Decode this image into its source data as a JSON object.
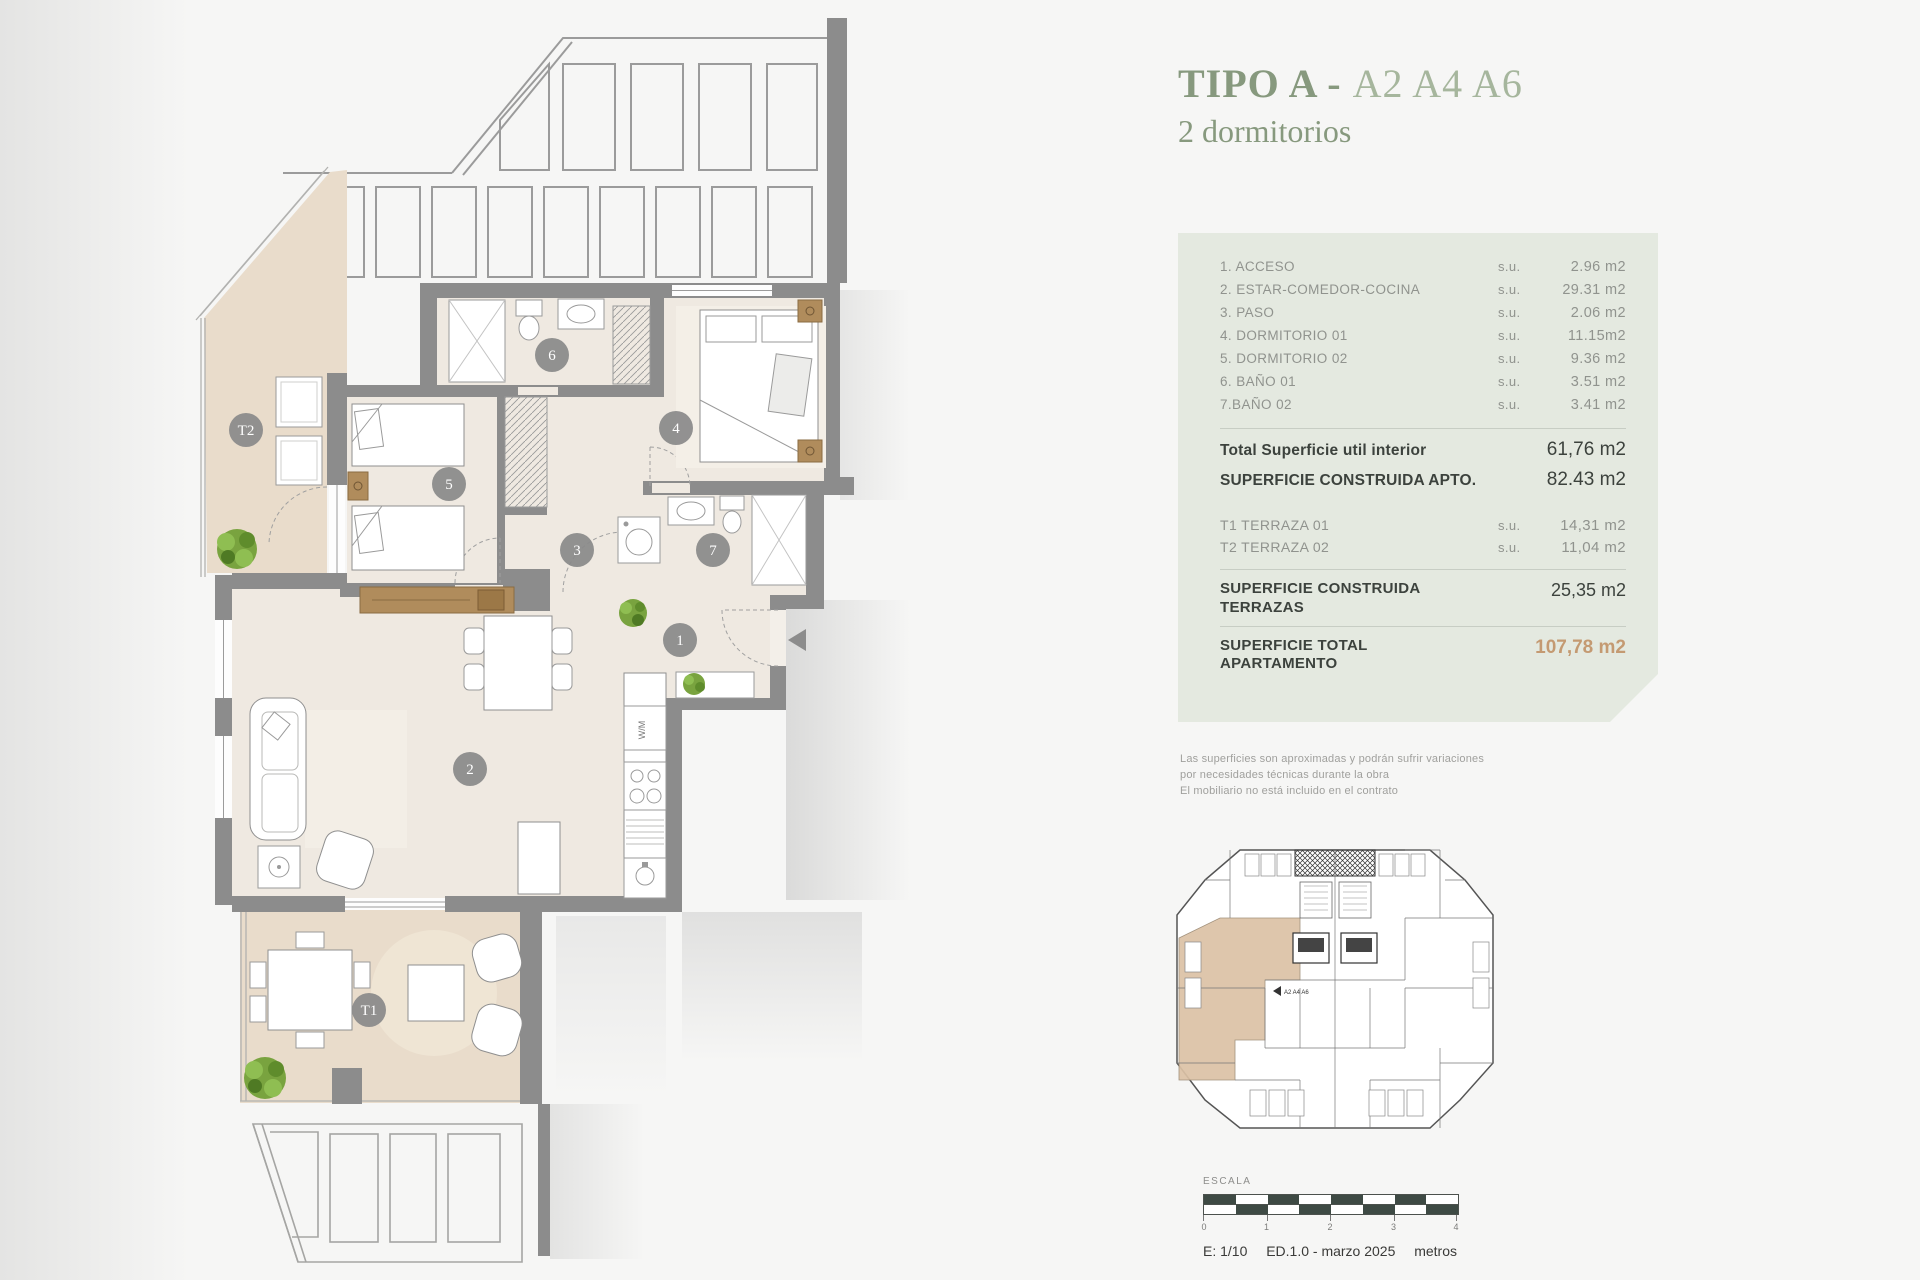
{
  "title": {
    "type_label": "TIPO A",
    "dash": " - ",
    "units": "A2 A4 A6",
    "subtitle": "2 dormitorios"
  },
  "panel": {
    "rooms": [
      {
        "label": "1. ACCESO",
        "su": "s.u.",
        "value": "2.96 m2"
      },
      {
        "label": "2. ESTAR-COMEDOR-COCINA",
        "su": "s.u.",
        "value": "29.31 m2"
      },
      {
        "label": "3. PASO",
        "su": "s.u.",
        "value": "2.06 m2"
      },
      {
        "label": "4. DORMITORIO 01",
        "su": "s.u.",
        "value": "11.15m2"
      },
      {
        "label": "5. DORMITORIO 02",
        "su": "s.u.",
        "value": "9.36 m2"
      },
      {
        "label": "6. BAÑO 01",
        "su": "s.u.",
        "value": "3.51 m2"
      },
      {
        "label": "7.BAÑO 02",
        "su": "s.u.",
        "value": "3.41 m2"
      }
    ],
    "total_interior": {
      "label": "Total Superficie util interior",
      "value": "61,76 m2"
    },
    "constructed": {
      "label": "SUPERFICIE CONSTRUIDA APTO.",
      "value": "82.43 m2"
    },
    "terraces": [
      {
        "label": "T1 TERRAZA 01",
        "su": "s.u.",
        "value": "14,31 m2"
      },
      {
        "label": "T2 TERRAZA 02",
        "su": "s.u.",
        "value": "11,04 m2"
      }
    ],
    "terraces_constructed": {
      "label": "SUPERFICIE CONSTRUIDA\nTERRAZAS",
      "value": "25,35 m2"
    },
    "total": {
      "label": "SUPERFICIE TOTAL\nAPARTAMENTO",
      "value": "107,78 m2"
    }
  },
  "disclaimer": {
    "line1": "Las superficies son aproximadas y podrán sufrir variaciones",
    "line2": "por necesidades técnicas durante la obra",
    "line3": "El mobiliario no está incluido en el contrato"
  },
  "plan": {
    "markers": [
      {
        "label": "1"
      },
      {
        "label": "2"
      },
      {
        "label": "3"
      },
      {
        "label": "4"
      },
      {
        "label": "5"
      },
      {
        "label": "6"
      },
      {
        "label": "7"
      },
      {
        "label": "T1"
      },
      {
        "label": "T2"
      }
    ],
    "wm_label": "W/M"
  },
  "keyplan": {
    "unit_label": "A2 A4 A6"
  },
  "scalebar": {
    "label": "ESCALA",
    "ticks": [
      "0",
      "1",
      "2",
      "3",
      "4"
    ],
    "scale": "E: 1/10",
    "edition": "ED.1.0 - marzo 2025",
    "units_label": "metros"
  },
  "colors": {
    "accent_green": "#87997e",
    "accent_green_light": "#a6b69d",
    "panel_bg": "#e4e9e0",
    "accent_orange": "#c49a72",
    "wall_gray": "#8c8c8c",
    "floor_interior": "#efe9e1",
    "floor_terrace": "#e9dccb",
    "scalebar_dark": "#3e4a44"
  }
}
